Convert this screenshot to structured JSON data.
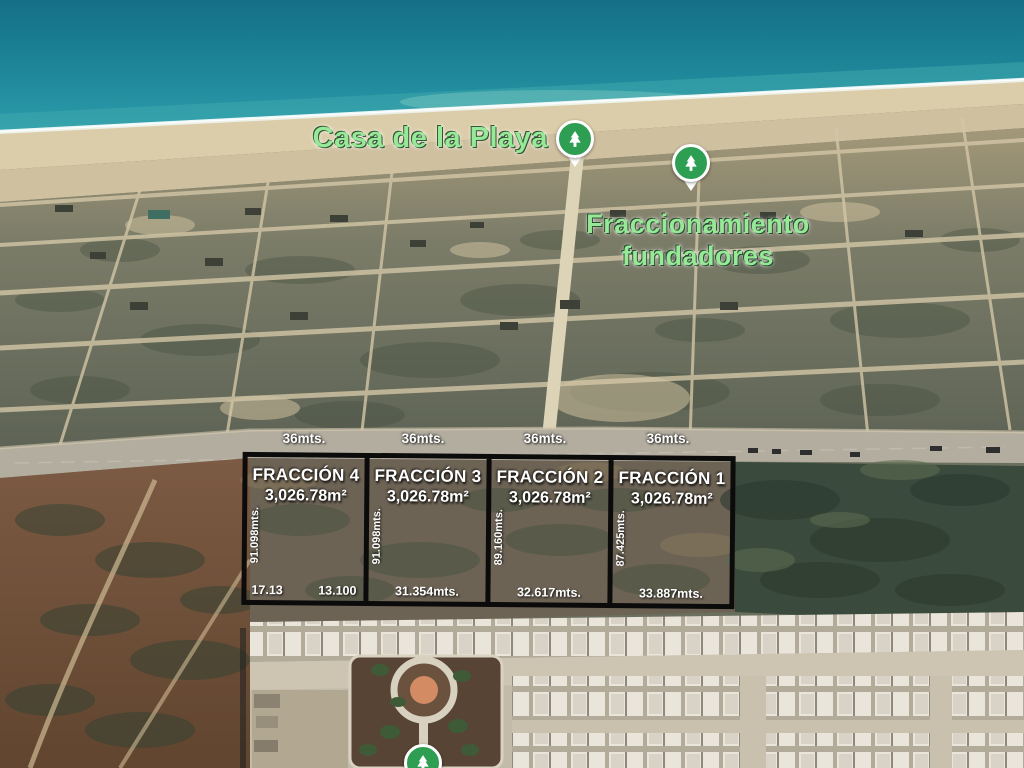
{
  "scene": {
    "description": "Aerial satellite view of beachfront land parcels for sale",
    "poi": {
      "beach_house_label": "Casa de la Playa",
      "subdivision_label_line1": "Fraccionamiento",
      "subdivision_label_line2": "fundadores"
    }
  },
  "parcels": {
    "street_widths": [
      "36mts.",
      "36mts.",
      "36mts.",
      "36mts."
    ],
    "items": [
      {
        "name": "FRACCIÓN 4",
        "area": "3,026.78m²",
        "depth": "91.098mts.",
        "bottom_left": "17.13",
        "bottom_right": "13.100"
      },
      {
        "name": "FRACCIÓN 3",
        "area": "3,026.78m²",
        "depth": "91.098mts.",
        "bottom": "31.354mts."
      },
      {
        "name": "FRACCIÓN 2",
        "area": "3,026.78m²",
        "depth": "89.160mts.",
        "bottom": "32.617mts."
      },
      {
        "name": "FRACCIÓN 1",
        "area": "3,026.78m²",
        "depth": "87.425mts.",
        "bottom": "33.887mts."
      }
    ]
  },
  "colors": {
    "ocean": "#1b7f95",
    "shore_turquoise": "#49b4b6",
    "foam": "#f2f7ee",
    "beach_sand": "#d9caa7",
    "scrubland": "#6b6f5e",
    "road": "#b5aea0",
    "red_scrub": "#74543f",
    "dark_vegetation": "#39493b",
    "park_ground": "#5a4536",
    "plaza_center": "#d28a62",
    "pin_green": "#2e9e53",
    "poi_label_green": "#97e897",
    "parcel_border": "#0b0b0b",
    "overlay_text": "#ffffff"
  }
}
